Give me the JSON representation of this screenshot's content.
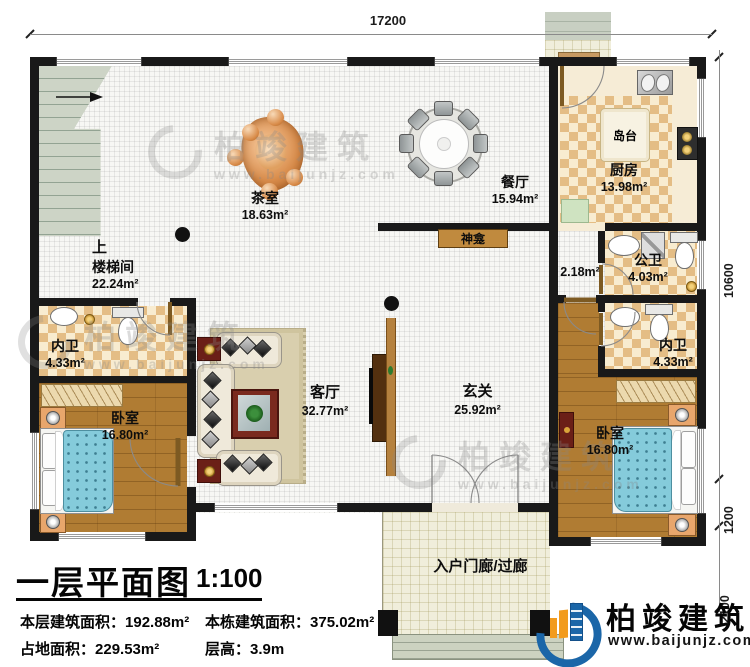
{
  "plan": {
    "title": "一层平面图",
    "scale": "1:100",
    "stats": {
      "floor_area_label": "本层建筑面积：",
      "floor_area_value": "192.88m²",
      "total_area_label": "本栋建筑面积：",
      "total_area_value": "375.02m²",
      "land_area_label": "占地面积：",
      "land_area_value": "229.53m²",
      "height_label": "层高：",
      "height_value": "3.9m"
    }
  },
  "dims": {
    "top": "17200",
    "right_upper": "10600",
    "right_middle": "1200",
    "right_lower": "2100"
  },
  "rooms": {
    "tea_room": {
      "name": "茶室",
      "area": "18.63m²"
    },
    "dining": {
      "name": "餐厅",
      "area": "15.94m²"
    },
    "kitchen": {
      "name": "厨房",
      "area": "13.98m²"
    },
    "island": {
      "name": "岛台"
    },
    "shrine": {
      "name": "神龛"
    },
    "stairs_up": {
      "name": "上"
    },
    "stairwell": {
      "name": "楼梯间",
      "area": "22.24m²"
    },
    "public_bath": {
      "name": "公卫",
      "area": "4.03m²"
    },
    "pantry": {
      "area": "2.18m²"
    },
    "ensuite_left": {
      "name": "内卫",
      "area": "4.33m²"
    },
    "ensuite_right": {
      "name": "内卫",
      "area": "4.33m²"
    },
    "bedroom_left": {
      "name": "卧室",
      "area": "16.80m²"
    },
    "bedroom_right": {
      "name": "卧室",
      "area": "16.80m²"
    },
    "living": {
      "name": "客厅",
      "area": "32.77m²"
    },
    "foyer": {
      "name": "玄关",
      "area": "25.92m²"
    },
    "porch": {
      "name": "入户门廊/过廊"
    }
  },
  "brand": {
    "name": "柏竣建筑",
    "url": "www.baijunjz.com"
  },
  "watermark": {
    "name": "柏竣建筑",
    "url": "www.baijunjz.com"
  },
  "colors": {
    "wall": "#191919",
    "checker_tile": "#e4bd85",
    "wood_floor": "#b07c33",
    "bed_blue": "#85cbdb",
    "stair_green": "#cdd4c6",
    "brand_blue": "#1b66a8",
    "brand_orange": "#f29b1d"
  }
}
